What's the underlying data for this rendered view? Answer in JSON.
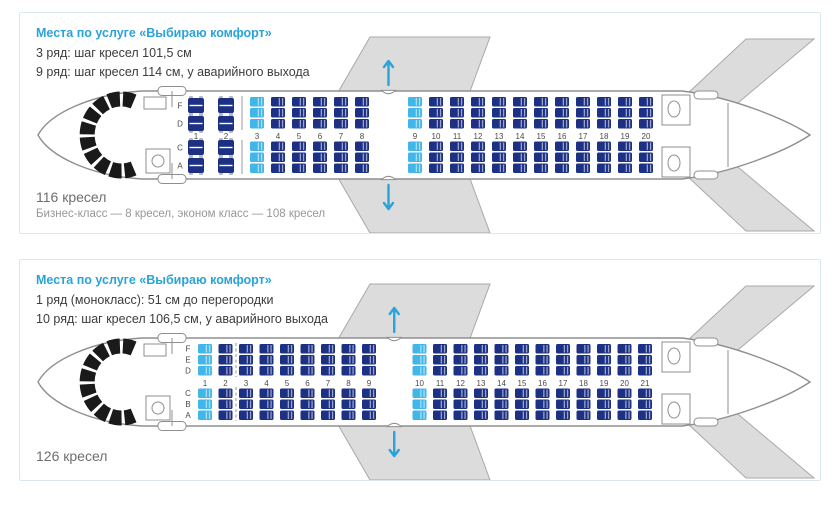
{
  "colors": {
    "seat_standard": "#1d3184",
    "seat_comfort": "#41b6e8",
    "accent": "#2aa3d8",
    "wing": "#dcdcdc",
    "wing_edge": "#a8a8a8",
    "outline": "#8f8f8f",
    "cockpit": "#1a1a1a",
    "text_dark": "#3c3c3c",
    "row_label": "#4a4a4a"
  },
  "planes": [
    {
      "title": "Места по услуге «Выбираю комфорт»",
      "notes": [
        "3 ряд: шаг кресел 101,5 см",
        "9 ряд: шаг кресел 114 см, у аварийного выхода"
      ],
      "seats_total": "116 кресел",
      "seats_breakdown": "Бизнес-класс — 8 кресел, эконом класс — 108 кресел",
      "cabin": {
        "business_rows": [
          1,
          2
        ],
        "economy_first_row": 3,
        "last_row": 20,
        "comfort_rows": [
          3,
          9
        ],
        "exit_after_row": 8,
        "letters_top": [
          "F",
          "D"
        ],
        "letters_bottom": [
          "C",
          "A"
        ]
      }
    },
    {
      "title": "Места по услуге «Выбираю комфорт»",
      "notes": [
        "1 ряд (монокласс): 51 см до перегородки",
        "10 ряд: шаг кресел 106,5 см, у аварийного выхода"
      ],
      "seats_total": "126 кресел",
      "seats_breakdown": "",
      "cabin": {
        "business_rows": [],
        "economy_first_row": 1,
        "last_row": 21,
        "comfort_rows": [
          1,
          10
        ],
        "exit_after_row": 9,
        "letters_top": [
          "F",
          "E",
          "D"
        ],
        "letters_bottom": [
          "C",
          "B",
          "A"
        ]
      }
    }
  ]
}
